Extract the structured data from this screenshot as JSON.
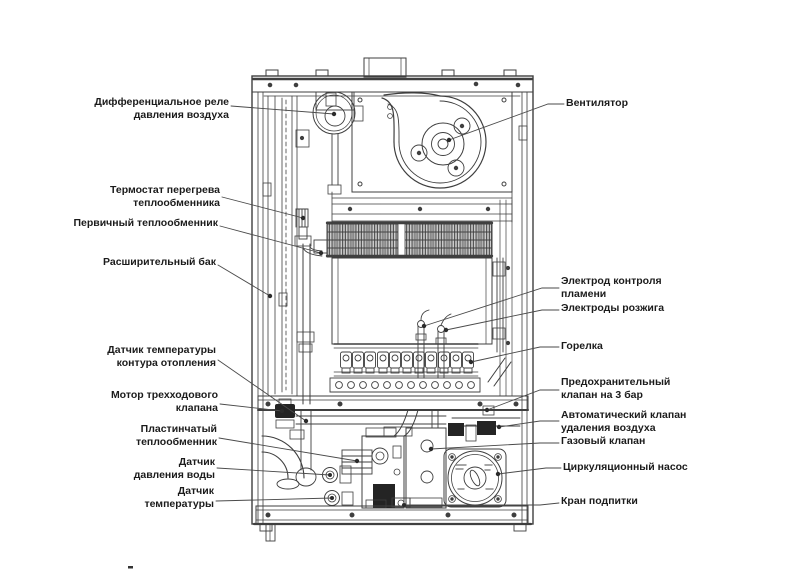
{
  "figure": {
    "kind": "boiler-internal-components-diagram",
    "colors": {
      "line": "#3f3f3f",
      "leader": "#4a4a4a",
      "text": "#1b1b1b",
      "background": "#ffffff",
      "fill_dark": "#242424"
    },
    "labels": {
      "left": [
        {
          "id": "air-pressure-switch",
          "text": "Дифференциальное реле\nдавления воздуха"
        },
        {
          "id": "overheat-thermostat",
          "text": "Термостат перегрева\nтеплообменника"
        },
        {
          "id": "primary-heat-exchanger",
          "text": "Первичный теплообменник"
        },
        {
          "id": "expansion-tank",
          "text": "Расширительный бак"
        },
        {
          "id": "heating-temp-sensor",
          "text": "Датчик температуры\nконтура отопления"
        },
        {
          "id": "three-way-valve-motor",
          "text": "Мотор трехходового\nклапана"
        },
        {
          "id": "plate-heat-exchanger",
          "text": "Пластинчатый\nтеплообменник"
        },
        {
          "id": "water-pressure-sensor",
          "text": "Датчик\nдавления воды"
        },
        {
          "id": "temperature-sensor",
          "text": "Датчик\nтемпературы"
        }
      ],
      "right": [
        {
          "id": "fan",
          "text": "Вентилятор"
        },
        {
          "id": "flame-control-electrode",
          "text": "Электрод контроля\nпламени"
        },
        {
          "id": "ignition-electrodes",
          "text": "Электроды розжига"
        },
        {
          "id": "burner",
          "text": "Горелка"
        },
        {
          "id": "safety-valve",
          "text": "Предохранительный\nклапан на 3 бар"
        },
        {
          "id": "auto-air-vent",
          "text": "Автоматический клапан\nудаления воздуха"
        },
        {
          "id": "gas-valve",
          "text": "Газовый клапан"
        },
        {
          "id": "circulation-pump",
          "text": "Циркуляционный насос"
        },
        {
          "id": "make-up-tap",
          "text": "Кран подпитки"
        }
      ]
    }
  }
}
